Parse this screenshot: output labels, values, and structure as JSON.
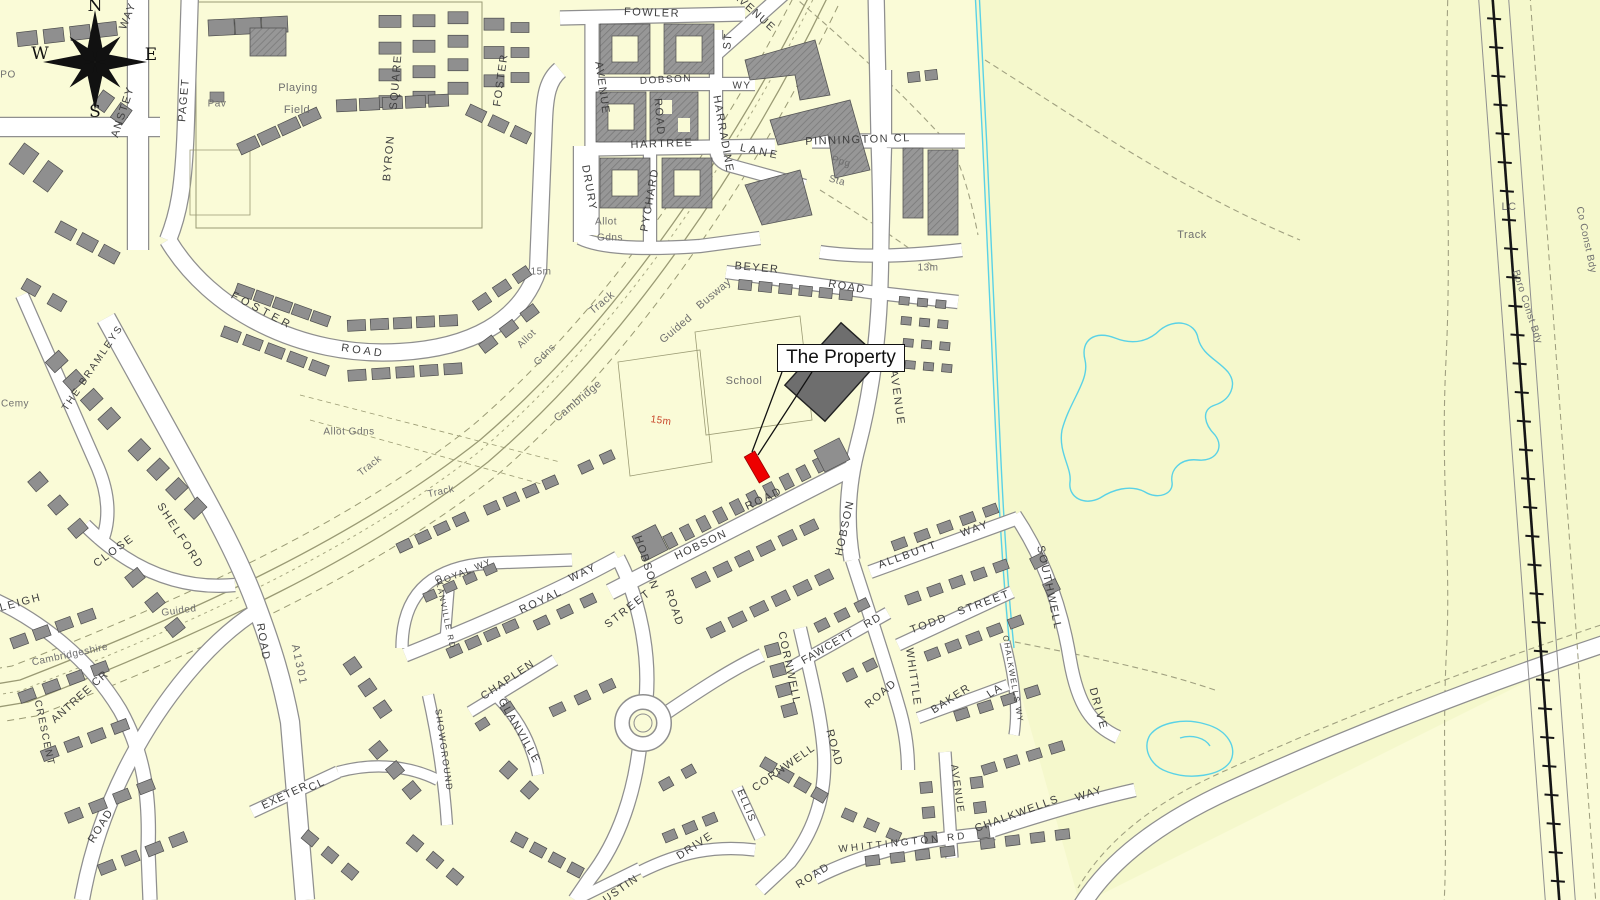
{
  "callout": {
    "text": "The Property"
  },
  "compass": {
    "n": "N",
    "e": "E",
    "s": "S",
    "w": "W"
  },
  "colors": {
    "background": "#fafbd7",
    "field": "#f5f8cc",
    "road_fill": "#ffffff",
    "road_casing": "#8f8f8f",
    "building": "#8f8f8f",
    "building_dark": "#6e6e6e",
    "plot_line": "#9b9b74",
    "water": "#5ad2e6",
    "railway": "#161616",
    "property_red": "#ee0000",
    "street_text": "#3f3f3f",
    "minor_text": "#6f6f6f",
    "contour_text": "#c8452a"
  },
  "labels": [
    {
      "t": "PO",
      "x": 8,
      "y": 75,
      "c": "mn",
      "s": 10
    },
    {
      "t": "WAY",
      "x": 128,
      "y": 16,
      "r": -68
    },
    {
      "t": "ANSTEY",
      "x": 123,
      "y": 112,
      "r": -72
    },
    {
      "t": "PAGET",
      "x": 184,
      "y": 100,
      "r": -85
    },
    {
      "t": "Pav",
      "x": 217,
      "y": 104,
      "c": "mn",
      "s": 10
    },
    {
      "t": "Playing",
      "x": 298,
      "y": 88,
      "c": "mn"
    },
    {
      "t": "Field",
      "x": 297,
      "y": 110,
      "c": "mn"
    },
    {
      "t": "SQUARE",
      "x": 396,
      "y": 82,
      "r": -85
    },
    {
      "t": "BYRON",
      "x": 389,
      "y": 158,
      "r": -85
    },
    {
      "t": "FOSTER",
      "x": 501,
      "y": 80,
      "r": -82
    },
    {
      "t": "FOWLER",
      "x": 652,
      "y": 13,
      "r": 2
    },
    {
      "t": "AVENUE",
      "x": 754,
      "y": 12,
      "r": 42
    },
    {
      "t": "ST",
      "x": 728,
      "y": 41,
      "r": -85
    },
    {
      "t": "AVENUE",
      "x": 602,
      "y": 88,
      "r": 82
    },
    {
      "t": "DOBSON",
      "x": 666,
      "y": 80,
      "s": 10,
      "r": -3
    },
    {
      "t": "WY",
      "x": 742,
      "y": 86,
      "s": 10
    },
    {
      "t": "ROAD",
      "x": 659,
      "y": 117,
      "r": 85
    },
    {
      "t": "HARTREE",
      "x": 662,
      "y": 144,
      "r": -2
    },
    {
      "t": "HARRADINE",
      "x": 723,
      "y": 134,
      "r": 80
    },
    {
      "t": "LANE",
      "x": 760,
      "y": 152,
      "r": 12,
      "ls": 3
    },
    {
      "t": "DRURY",
      "x": 589,
      "y": 188,
      "r": 80
    },
    {
      "t": "PYCHARD",
      "x": 650,
      "y": 200,
      "r": -80
    },
    {
      "t": "Allot",
      "x": 606,
      "y": 222,
      "c": "mn",
      "s": 10
    },
    {
      "t": "Gdns",
      "x": 610,
      "y": 238,
      "c": "mn",
      "s": 10
    },
    {
      "t": "PINNINGTON CL",
      "x": 858,
      "y": 140,
      "r": -2
    },
    {
      "t": "Ppg",
      "x": 841,
      "y": 162,
      "c": "mn",
      "s": 10,
      "r": 15
    },
    {
      "t": "Sta",
      "x": 837,
      "y": 181,
      "c": "mn",
      "s": 10,
      "r": 15
    },
    {
      "t": "13m",
      "x": 928,
      "y": 268,
      "c": "mn",
      "s": 10
    },
    {
      "t": "BEYER",
      "x": 757,
      "y": 268,
      "r": 5
    },
    {
      "t": "ROAD",
      "x": 847,
      "y": 287,
      "r": 10
    },
    {
      "t": "Track",
      "x": 1192,
      "y": 235,
      "c": "mn"
    },
    {
      "t": "LC",
      "x": 1509,
      "y": 207,
      "c": "mn"
    },
    {
      "t": "Co Const Bdy",
      "x": 1586,
      "y": 240,
      "r": 78,
      "c": "mn",
      "s": 10
    },
    {
      "t": "Boro Const Bdy",
      "x": 1527,
      "y": 307,
      "r": 72,
      "c": "mn",
      "s": 10
    },
    {
      "t": "15m",
      "x": 541,
      "y": 272,
      "c": "mn",
      "s": 10
    },
    {
      "t": "FOSTER",
      "x": 262,
      "y": 311,
      "r": 28,
      "ls": 4
    },
    {
      "t": "ROAD",
      "x": 363,
      "y": 351,
      "r": 8,
      "ls": 3
    },
    {
      "t": "Allot",
      "x": 527,
      "y": 339,
      "r": -45,
      "c": "mn",
      "s": 10
    },
    {
      "t": "Gdns",
      "x": 545,
      "y": 355,
      "r": -45,
      "c": "mn",
      "s": 10
    },
    {
      "t": "Allot Gdns",
      "x": 349,
      "y": 432,
      "c": "mn",
      "s": 10
    },
    {
      "t": "Track",
      "x": 370,
      "y": 466,
      "r": -38,
      "c": "mn",
      "s": 10
    },
    {
      "t": "Track",
      "x": 441,
      "y": 492,
      "r": -12,
      "c": "mn",
      "s": 10
    },
    {
      "t": "Track",
      "x": 602,
      "y": 303,
      "r": -40,
      "c": "mn"
    },
    {
      "t": "Guided",
      "x": 676,
      "y": 329,
      "r": -40,
      "c": "mn"
    },
    {
      "t": "Busway",
      "x": 714,
      "y": 294,
      "r": -40,
      "c": "mn"
    },
    {
      "t": "Cambridge",
      "x": 578,
      "y": 401,
      "r": -40,
      "c": "mn"
    },
    {
      "t": "15m",
      "x": 661,
      "y": 421,
      "r": 8,
      "c": "ct",
      "s": 10
    },
    {
      "t": "School",
      "x": 744,
      "y": 381,
      "c": "mn"
    },
    {
      "t": "Cemy",
      "x": 15,
      "y": 404,
      "c": "mn",
      "s": 10
    },
    {
      "t": "THE BRAMLEYS",
      "x": 93,
      "y": 368,
      "r": -56,
      "ls": 2,
      "s": 10
    },
    {
      "t": "SHELFORD",
      "x": 180,
      "y": 536,
      "r": 57,
      "ls": 2
    },
    {
      "t": "ROAD",
      "x": 263,
      "y": 642,
      "r": 80
    },
    {
      "t": "A1301",
      "x": 299,
      "y": 665,
      "r": 78,
      "c": "bg"
    },
    {
      "t": "CLOSE",
      "x": 114,
      "y": 551,
      "r": -36,
      "ls": 2
    },
    {
      "t": "NLEIGH",
      "x": 16,
      "y": 604,
      "r": -15,
      "ls": 2
    },
    {
      "t": "Guided",
      "x": 179,
      "y": 611,
      "r": -8,
      "c": "mn",
      "s": 10
    },
    {
      "t": "Cambridgeshire",
      "x": 70,
      "y": 655,
      "r": -12,
      "c": "mn",
      "s": 10
    },
    {
      "t": "ANTREE CR",
      "x": 80,
      "y": 697,
      "r": -42,
      "ls": 1
    },
    {
      "t": "CRESCENT",
      "x": 44,
      "y": 733,
      "r": 78,
      "s": 10
    },
    {
      "t": "ROAD",
      "x": 101,
      "y": 826,
      "r": -58
    },
    {
      "t": "EXETER",
      "x": 285,
      "y": 796,
      "r": -25,
      "ls": 1
    },
    {
      "t": "CL",
      "x": 317,
      "y": 785,
      "r": -25
    },
    {
      "t": "SHOWGROUND",
      "x": 444,
      "y": 750,
      "r": 82,
      "s": 9
    },
    {
      "t": "ROYAL WY",
      "x": 464,
      "y": 572,
      "r": -22,
      "s": 9
    },
    {
      "t": "GLANVILLE RD",
      "x": 445,
      "y": 612,
      "r": 78,
      "s": 8
    },
    {
      "t": "ROYAL",
      "x": 541,
      "y": 601,
      "r": -25,
      "ls": 2
    },
    {
      "t": "WAY",
      "x": 583,
      "y": 573,
      "r": -25,
      "ls": 2
    },
    {
      "t": "STREET",
      "x": 628,
      "y": 609,
      "r": -38,
      "ls": 2
    },
    {
      "t": "HOBSON",
      "x": 646,
      "y": 563,
      "r": 72
    },
    {
      "t": "ROAD",
      "x": 674,
      "y": 608,
      "r": 72
    },
    {
      "t": "CHAPLEN",
      "x": 508,
      "y": 680,
      "r": -34
    },
    {
      "t": "GLANVILLE",
      "x": 519,
      "y": 731,
      "r": 60
    },
    {
      "t": "HOBSON",
      "x": 701,
      "y": 545,
      "r": -25
    },
    {
      "t": "ROAD",
      "x": 764,
      "y": 499,
      "r": -25,
      "ls": 2
    },
    {
      "t": "AVENUE",
      "x": 897,
      "y": 398,
      "r": 82,
      "ls": 2
    },
    {
      "t": "HOBSON",
      "x": 845,
      "y": 528,
      "r": -78
    },
    {
      "t": "ALLBUTT",
      "x": 908,
      "y": 555,
      "r": -20,
      "ls": 2
    },
    {
      "t": "WAY",
      "x": 975,
      "y": 529,
      "r": -20,
      "ls": 2
    },
    {
      "t": "SOUTHWELL",
      "x": 1049,
      "y": 588,
      "r": 78,
      "ls": 2
    },
    {
      "t": "DRIVE",
      "x": 1098,
      "y": 709,
      "r": 75,
      "ls": 2
    },
    {
      "t": "TODD",
      "x": 929,
      "y": 624,
      "r": -20,
      "ls": 2
    },
    {
      "t": "STREET",
      "x": 984,
      "y": 603,
      "r": -20,
      "ls": 2
    },
    {
      "t": "WHITTLE",
      "x": 913,
      "y": 677,
      "r": 82
    },
    {
      "t": "ROAD",
      "x": 881,
      "y": 694,
      "r": -40
    },
    {
      "t": "CORNWELL",
      "x": 789,
      "y": 668,
      "r": 78
    },
    {
      "t": "ROAD",
      "x": 834,
      "y": 748,
      "r": 75
    },
    {
      "t": "FAWCETT",
      "x": 828,
      "y": 647,
      "r": -30,
      "ls": 1
    },
    {
      "t": "RD",
      "x": 873,
      "y": 621,
      "r": -30
    },
    {
      "t": "CORNWELL",
      "x": 784,
      "y": 768,
      "r": -35
    },
    {
      "t": "ROAD",
      "x": 813,
      "y": 876,
      "r": -32
    },
    {
      "t": "ELLIS",
      "x": 746,
      "y": 806,
      "r": 68,
      "s": 10
    },
    {
      "t": "BAKER",
      "x": 951,
      "y": 699,
      "r": -33
    },
    {
      "t": "LA",
      "x": 995,
      "y": 691,
      "r": -33
    },
    {
      "t": "CHALKWELLS WY",
      "x": 1013,
      "y": 679,
      "r": 80,
      "s": 8
    },
    {
      "t": "AVENUE",
      "x": 957,
      "y": 789,
      "r": 82,
      "s": 10
    },
    {
      "t": "WHITTINGTON RD",
      "x": 903,
      "y": 843,
      "r": -6,
      "ls": 3,
      "s": 10
    },
    {
      "t": "CHALKWELLS",
      "x": 1017,
      "y": 814,
      "r": -20
    },
    {
      "t": "WAY",
      "x": 1089,
      "y": 794,
      "r": -18
    },
    {
      "t": "DRIVE",
      "x": 695,
      "y": 846,
      "r": -33
    },
    {
      "t": "USTIN",
      "x": 621,
      "y": 889,
      "r": -35
    }
  ]
}
